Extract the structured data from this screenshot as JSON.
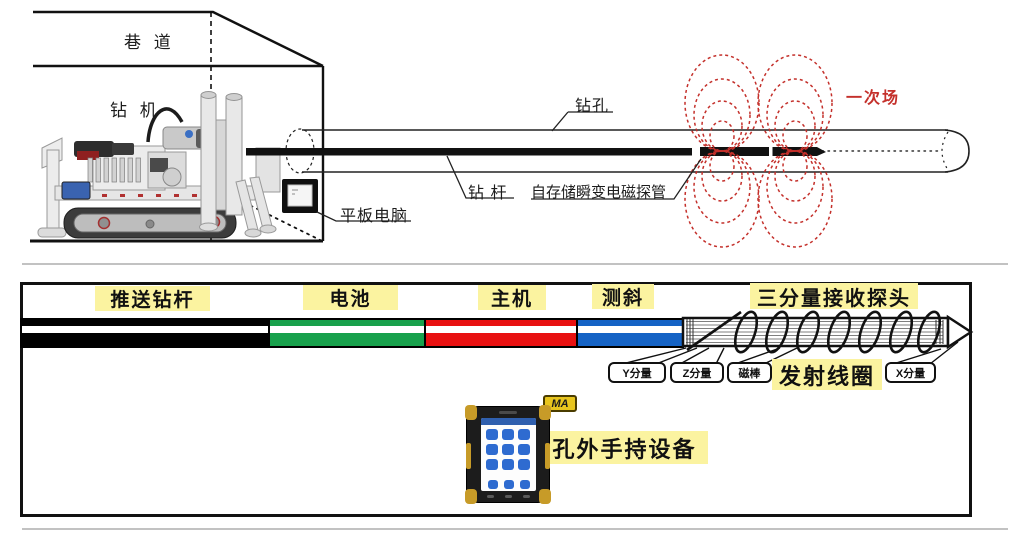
{
  "top": {
    "tunnel_label": "巷 道",
    "rig_label": "钻 机",
    "borehole_label": "钻孔",
    "rod_label": "钻 杆",
    "probe_label": "自存储瞬变电磁探管",
    "tablet_label": "平板电脑",
    "primary_field_label": "一次场",
    "field_color": "#c4302b"
  },
  "bottom": {
    "push_rod_label": "推送钻杆",
    "battery_label": "电池",
    "host_label": "主机",
    "incline_label": "测斜",
    "receiver_label": "三分量接收探头",
    "coil_label": "发射线圈",
    "tags": {
      "y": "Y分量",
      "z": "Z分量",
      "magnet": "磁棒",
      "x": "X分量"
    },
    "handheld_label": "孔外手持设备",
    "ma_mark": "MA",
    "colors": {
      "push_rod": "#000000",
      "battery": "#18a14c",
      "host": "#e81111",
      "incline": "#1563c5",
      "highlight": "#fbf3a0",
      "field_red": "#c4302b",
      "ma_yellow": "#e8c51e"
    }
  }
}
